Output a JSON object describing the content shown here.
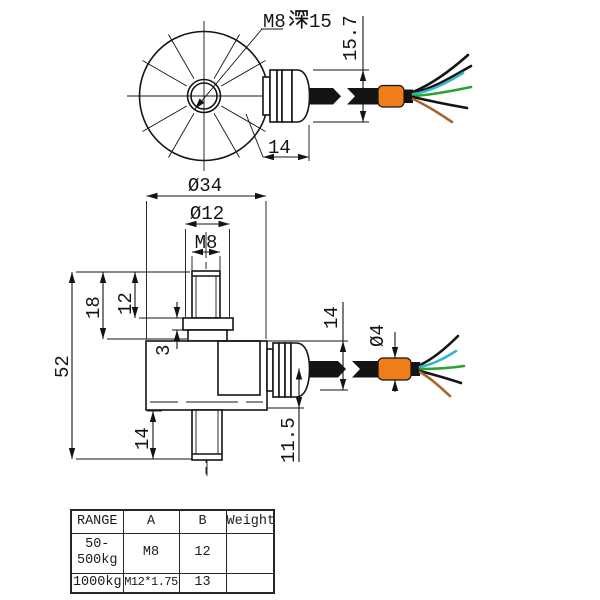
{
  "palette": {
    "line": "#141414",
    "cable_orange": "#ee7d1a",
    "wire_black": "#141414",
    "wire_cyan": "#2eb8c8",
    "wire_green": "#2ca32c",
    "wire_brown": "#a8652c"
  },
  "top_view": {
    "thread_note": "M8深15",
    "thread_note_prefix": "M8",
    "thread_note_suffix": "15",
    "gland_cable_height": "15.7",
    "gland_length": "14"
  },
  "side_view": {
    "body_dia": "Ø34",
    "boss_dia": "Ø12",
    "top_thread": "M8",
    "total_height": "52",
    "upper_height": "18",
    "boss_height": "12",
    "step_height": "3",
    "stud_length": "14",
    "gland_height": "14",
    "cable_dia": "Ø4",
    "cable_center_offset": "11.5"
  },
  "table": {
    "headers": [
      "RANGE",
      "A",
      "B",
      "Weight"
    ],
    "rows": [
      {
        "range": "50-\n500kg",
        "a": "M8",
        "b": "12",
        "weight": ""
      },
      {
        "range": "1000kg",
        "a": "M12*1.75",
        "b": "13",
        "weight": ""
      }
    ]
  }
}
